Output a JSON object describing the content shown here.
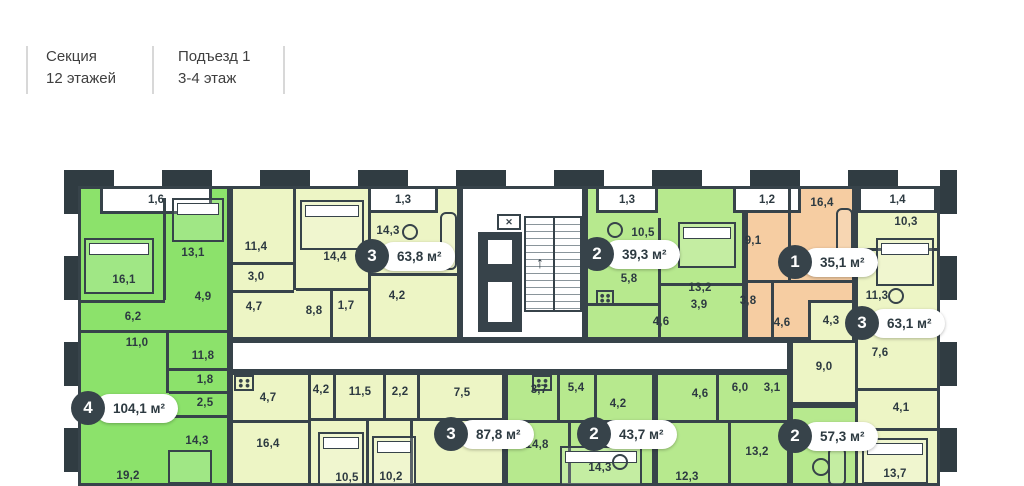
{
  "header": {
    "section_label": "Секция",
    "section_floors": "12 этажей",
    "entrance_label": "Подъезд 1",
    "entrance_floors": "3-4 этаж"
  },
  "core": {
    "stairs_arrow": "↑",
    "vent_mark": "✕"
  },
  "colors": {
    "wall": "#37434a",
    "apartment_4_rooms": "#8ce26b",
    "apartment_2_rooms": "#b7e98e",
    "apartment_3_rooms": "#edf5c5",
    "apartment_1_room": "#f6cda2",
    "badge_circle": "#37434a",
    "badge_pill": "#ffffff",
    "label_text": "#2d3a41"
  },
  "apartments": [
    {
      "badge": "4",
      "area": "104,1 м²",
      "rooms": [
        "1,6",
        "16,1",
        "13,1",
        "6,2",
        "4,9",
        "11,0",
        "11,8",
        "1,8",
        "2,5",
        "14,3",
        "19,2"
      ]
    },
    {
      "badge": "3",
      "area": "63,8 м²",
      "rooms": [
        "1,3",
        "11,4",
        "3,0",
        "4,7",
        "14,4",
        "8,8",
        "1,7",
        "14,3",
        "4,2"
      ]
    },
    {
      "badge": "2",
      "area": "39,3 м²",
      "rooms": [
        "1,3",
        "10,5",
        "5,8",
        "13,2",
        "3,9",
        "4,6"
      ]
    },
    {
      "badge": "1",
      "area": "35,1 м²",
      "rooms": [
        "1,2",
        "16,4",
        "9,1",
        "3,8",
        "4,6"
      ]
    },
    {
      "badge": "3",
      "area": "63,1 м²",
      "rooms": [
        "1,4",
        "10,3",
        "11,3",
        "4,3",
        "7,6",
        "9,0",
        "4,1",
        "13,7"
      ]
    },
    {
      "badge": "3",
      "area": "87,8 м²",
      "rooms": [
        "4,7",
        "16,4",
        "4,2",
        "11,5",
        "2,2",
        "7,5",
        "10,5",
        "10,2"
      ]
    },
    {
      "badge": "2",
      "area": "43,7 м²",
      "rooms": [
        "3,7",
        "5,4",
        "4,2",
        "14,8",
        "14,3"
      ]
    },
    {
      "badge": "2",
      "area": "57,3 м²",
      "rooms": [
        "4,6",
        "6,0",
        "3,1",
        "12,3",
        "13,2"
      ]
    }
  ],
  "icons": [
    "stairs-up-arrow-icon",
    "vent-shaft-icon",
    "bed-icon",
    "sofa-icon",
    "table-icon",
    "stove-icon"
  ]
}
